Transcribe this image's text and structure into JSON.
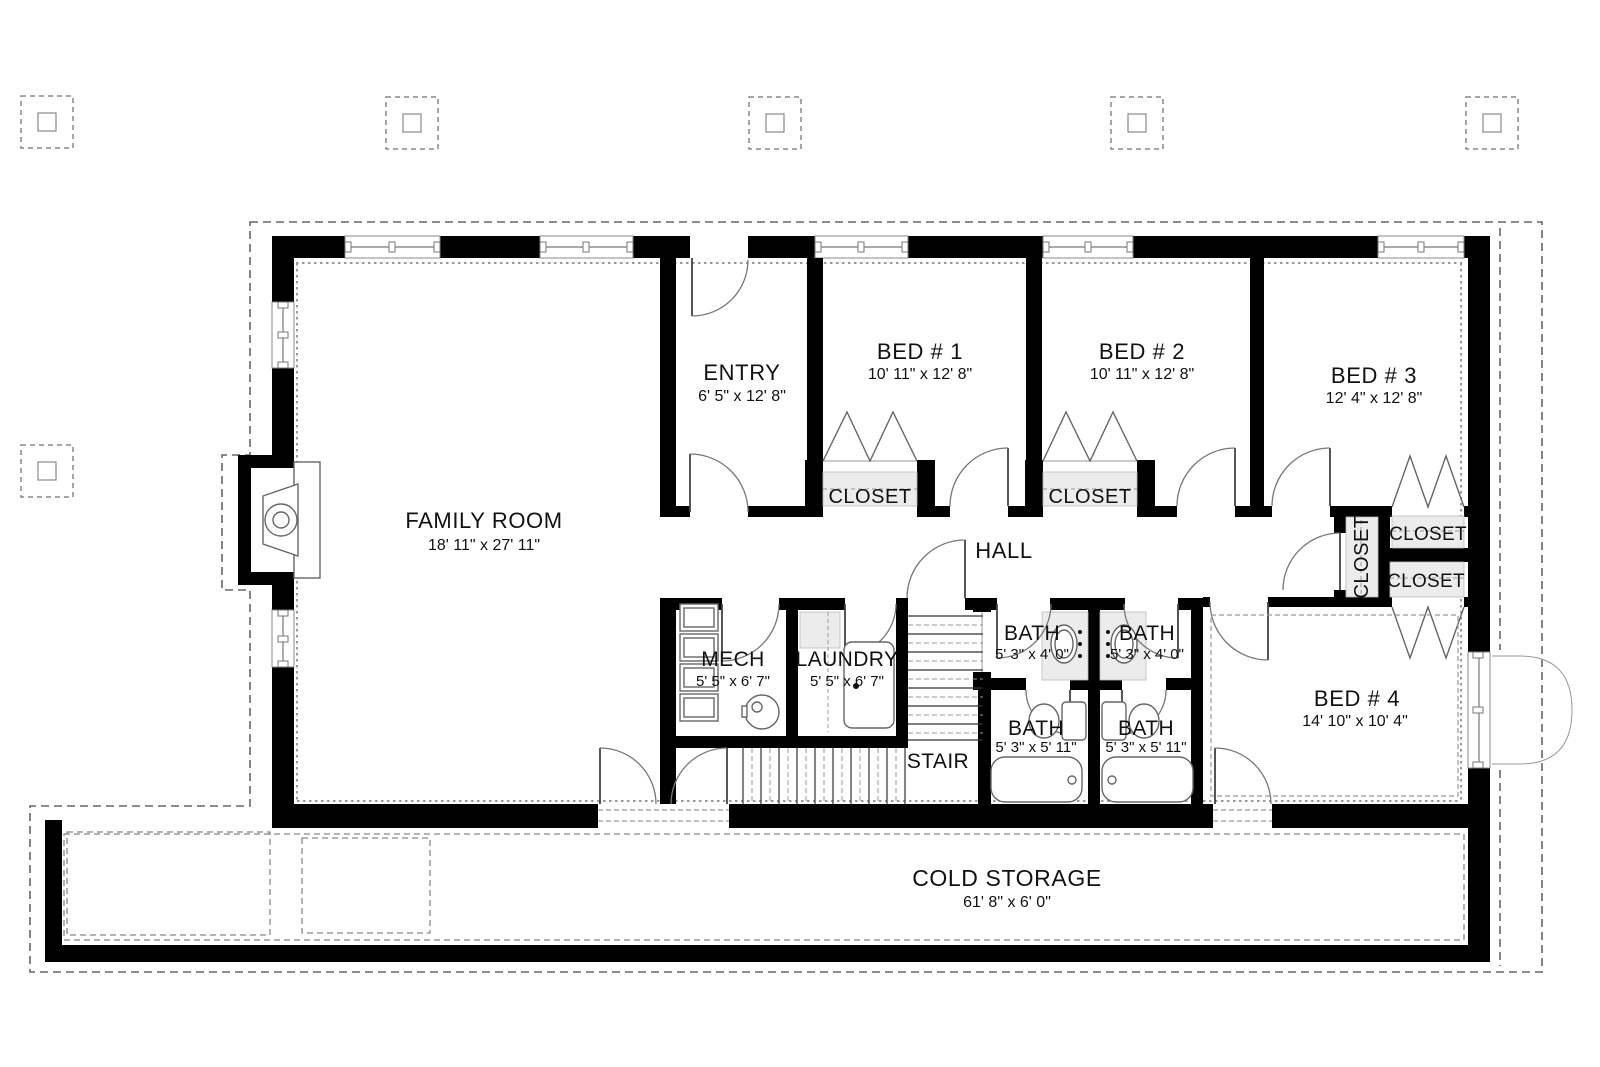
{
  "colors": {
    "background": "#ffffff",
    "wall": "#000000",
    "closet_shade": "#ececec",
    "line": "#666666"
  },
  "rooms": {
    "family": {
      "name": "FAMILY ROOM",
      "dims": "18' 11\" x 27' 11\""
    },
    "entry": {
      "name": "ENTRY",
      "dims": "6' 5\" x 12' 8\""
    },
    "bed1": {
      "name": "BED # 1",
      "dims": "10' 11\" x 12' 8\""
    },
    "bed2": {
      "name": "BED # 2",
      "dims": "10' 11\" x 12' 8\""
    },
    "bed3": {
      "name": "BED # 3",
      "dims": "12' 4\" x 12' 8\""
    },
    "bed4": {
      "name": "BED # 4",
      "dims": "14' 10\" x 10' 4\""
    },
    "hall": {
      "name": "HALL"
    },
    "stair": {
      "name": "STAIR"
    },
    "mech": {
      "name": "MECH",
      "dims": "5' 5\" x 6' 7\""
    },
    "laundry": {
      "name": "LAUNDRY",
      "dims": "5' 5\" x 6' 7\""
    },
    "bath_ul": {
      "name": "BATH",
      "dims": "5' 3\" x 4' 0\""
    },
    "bath_ur": {
      "name": "BATH",
      "dims": "5' 3\" x 4' 0\""
    },
    "bath_ll": {
      "name": "BATH",
      "dims": "5' 3\" x 5' 11\""
    },
    "bath_lr": {
      "name": "BATH",
      "dims": "5' 3\" x 5' 11\""
    },
    "cold": {
      "name": "COLD STORAGE",
      "dims": "61' 8\" x 6' 0\""
    }
  },
  "closets": {
    "bed1": {
      "label": "CLOSET"
    },
    "bed2": {
      "label": "CLOSET"
    },
    "linen": {
      "label": "CLOSET"
    },
    "bed3": {
      "label": "CLOSET"
    },
    "bed4": {
      "label": "CLOSET"
    }
  }
}
